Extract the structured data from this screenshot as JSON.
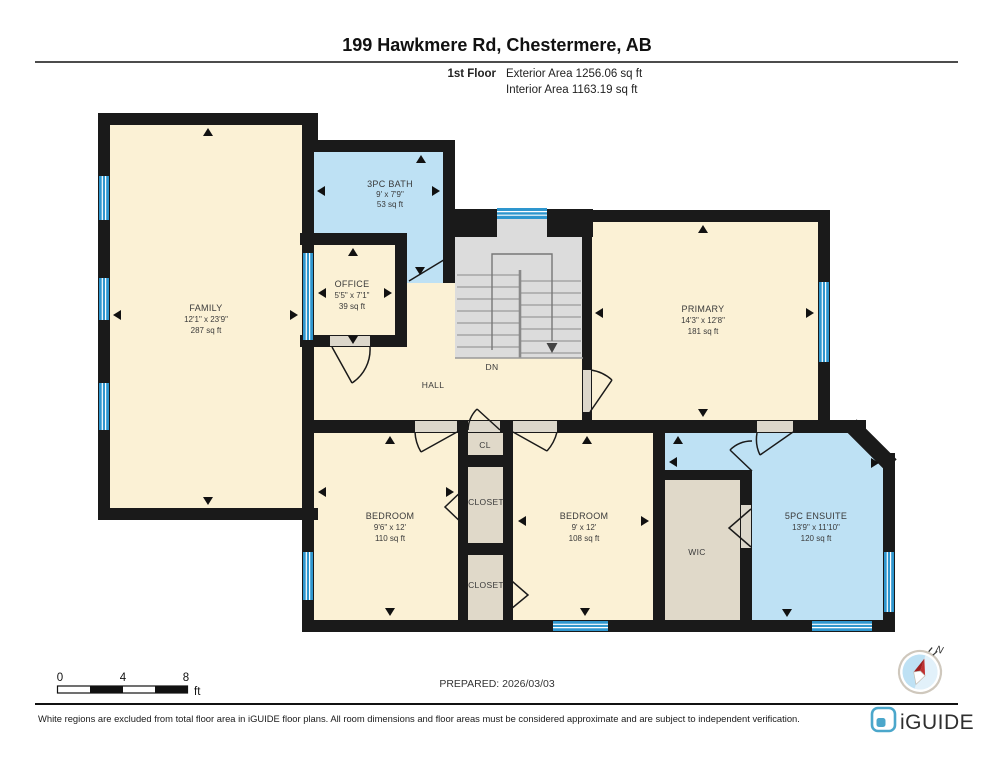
{
  "header": {
    "title": "199 Hawkmere Rd, Chestermere, AB",
    "floor_label": "1st Floor",
    "exterior_area": "Exterior Area 1256.06 sq ft",
    "interior_area": "Interior Area 1163.19 sq ft"
  },
  "rooms": [
    {
      "id": "family",
      "name": "FAMILY",
      "dims": "12'1\" x 23'9\"",
      "area": "287 sq ft"
    },
    {
      "id": "bath",
      "name": "3PC BATH",
      "dims": "9' x 7'9\"",
      "area": "53 sq ft"
    },
    {
      "id": "office",
      "name": "OFFICE",
      "dims": "5'5\" x 7'1\"",
      "area": "39 sq ft"
    },
    {
      "id": "primary",
      "name": "PRIMARY",
      "dims": "14'3\" x 12'8\"",
      "area": "181 sq ft"
    },
    {
      "id": "bedroom-left",
      "name": "BEDROOM",
      "dims": "9'6\" x 12'",
      "area": "110 sq ft"
    },
    {
      "id": "bedroom-right",
      "name": "BEDROOM",
      "dims": "9' x 12'",
      "area": "108 sq ft"
    },
    {
      "id": "ensuite",
      "name": "5PC ENSUITE",
      "dims": "13'9\" x 11'10\"",
      "area": "120 sq ft"
    }
  ],
  "labels": {
    "hall": "HALL",
    "dn": "DN",
    "wic": "WIC",
    "cl": "CL",
    "closet_mid": "CLOSET",
    "closet_bottom": "CLOSET"
  },
  "scale_bar": {
    "ticks": [
      "0",
      "4",
      "8"
    ],
    "unit": "ft"
  },
  "prepared": "PREPARED: 2026/03/03",
  "compass": {
    "north_label": "N"
  },
  "footer": {
    "disclaimer": "White regions are excluded from total floor area in iGUIDE floor plans. All room dimensions and floor areas must be considered approximate and are subject to independent verification.",
    "brand": "iGUIDE"
  },
  "colors": {
    "wall": "#1a1a1a",
    "room_cream": "#FBF1D5",
    "room_blue": "#BEE1F4",
    "room_tan": "#E0D9C9",
    "stairs": "#DCDCDC",
    "window": "#2E96CE",
    "threshold": "#DCD7CB",
    "brand": "#4BA7CB"
  }
}
